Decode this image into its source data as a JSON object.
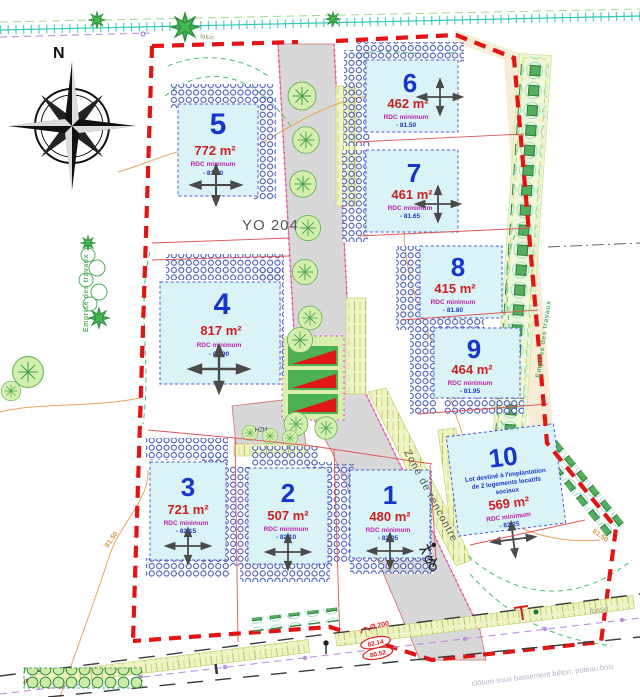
{
  "compass": {
    "north_label": "N"
  },
  "parcel_ref": "YO 204",
  "road": {
    "zone_label": "Zone de rencontre"
  },
  "labels": {
    "talus": "talus",
    "fosse": "fossé",
    "fence_note": "clôture sous bassement béton, poteau bois",
    "hzh": "HZH",
    "emprise_travaux": "Emprise des travaux",
    "contour_81_50": "81.50",
    "pipe_diameter": "Ø 200",
    "pipe_level_top": "82.14",
    "pipe_level_bottom": "80.52"
  },
  "lots": [
    {
      "number": "1",
      "area": "480 m²",
      "rdc_label": "RDC minimum",
      "rdc_value": "-  82.05"
    },
    {
      "number": "2",
      "area": "507 m²",
      "rdc_label": "RDC minimum",
      "rdc_value": "-  82.10"
    },
    {
      "number": "3",
      "area": "721 m²",
      "rdc_label": "RDC minimum",
      "rdc_value": "-  82.15"
    },
    {
      "number": "4",
      "area": "817 m²",
      "rdc_label": "RDC minimum",
      "rdc_value": "-  81.90"
    },
    {
      "number": "5",
      "area": "772 m²",
      "rdc_label": "RDC minimum",
      "rdc_value": "-  81.60"
    },
    {
      "number": "6",
      "area": "462 m²",
      "rdc_label": "RDC minimum",
      "rdc_value": "-  81.50"
    },
    {
      "number": "7",
      "area": "461 m²",
      "rdc_label": "RDC minimum",
      "rdc_value": "-  81.65"
    },
    {
      "number": "8",
      "area": "415 m²",
      "rdc_label": "RDC minimum",
      "rdc_value": "-  81.80"
    },
    {
      "number": "9",
      "area": "464 m²",
      "rdc_label": "RDC minimum",
      "rdc_value": "-  81.95"
    },
    {
      "number": "10",
      "area": "569 m²",
      "rdc_label": "RDC minimum",
      "rdc_value": "-  82.25",
      "note_line1": "Lot destiné à l'implantation",
      "note_line2": "de 2 logements locatifs",
      "note_line3": "sociaux"
    }
  ]
}
